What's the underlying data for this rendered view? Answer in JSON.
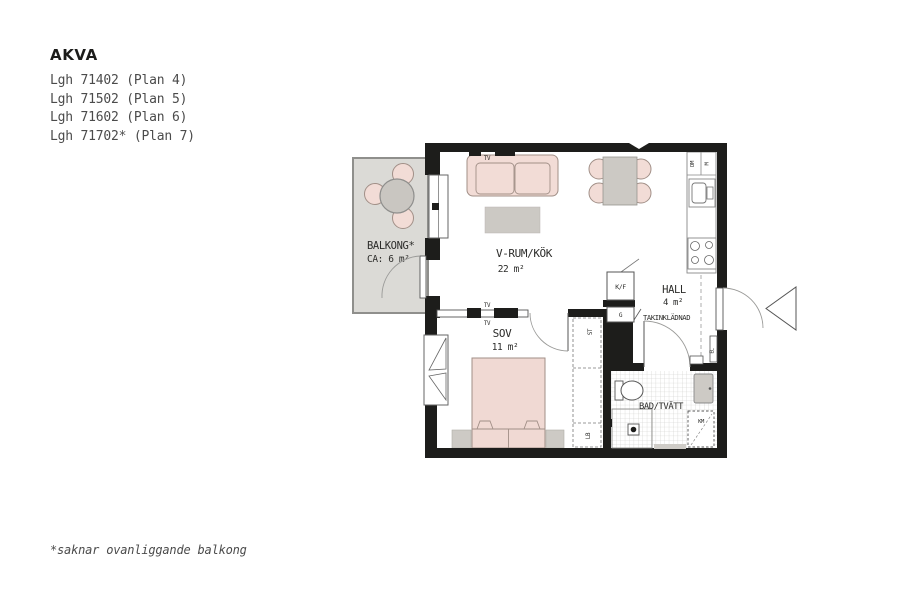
{
  "header": {
    "project": "AKVA",
    "apartments": [
      "Lgh 71402 (Plan 4)",
      "Lgh 71502 (Plan 5)",
      "Lgh 71602 (Plan 6)",
      "Lgh 71702* (Plan 7)"
    ]
  },
  "footnote": "*saknar ovanliggande balkong",
  "plan": {
    "rooms": {
      "balcony": {
        "label": "BALKONG*",
        "area": "CA: 6 m²"
      },
      "living_kitchen": {
        "label": "V-RUM/KÖK",
        "area": "22 m²"
      },
      "bedroom": {
        "label": "SOV",
        "area": "11 m²"
      },
      "hall": {
        "label": "HALL",
        "area": "4 m²"
      },
      "bathroom": {
        "label": "BAD/TVÄTT"
      }
    },
    "annotations": {
      "ceiling_cladding": "TAKINKLÄDNAD",
      "tv_outlet": "TV"
    },
    "fixtures": {
      "fridge_freezer": "K/F",
      "hall_wardrobe": "G",
      "dishwasher": "DM",
      "microwave": "M",
      "cleaning_cabinet": "ST",
      "linen_cabinet": "LB",
      "washing_machine": "KM",
      "electrical_panel": "EL"
    },
    "colors": {
      "wall": "#1d1d1b",
      "furniture_pink": "#f2dcd6",
      "furniture_gray": "#cdcac5",
      "balcony_floor": "#dbdad6",
      "text": "#2c2c2a"
    }
  }
}
